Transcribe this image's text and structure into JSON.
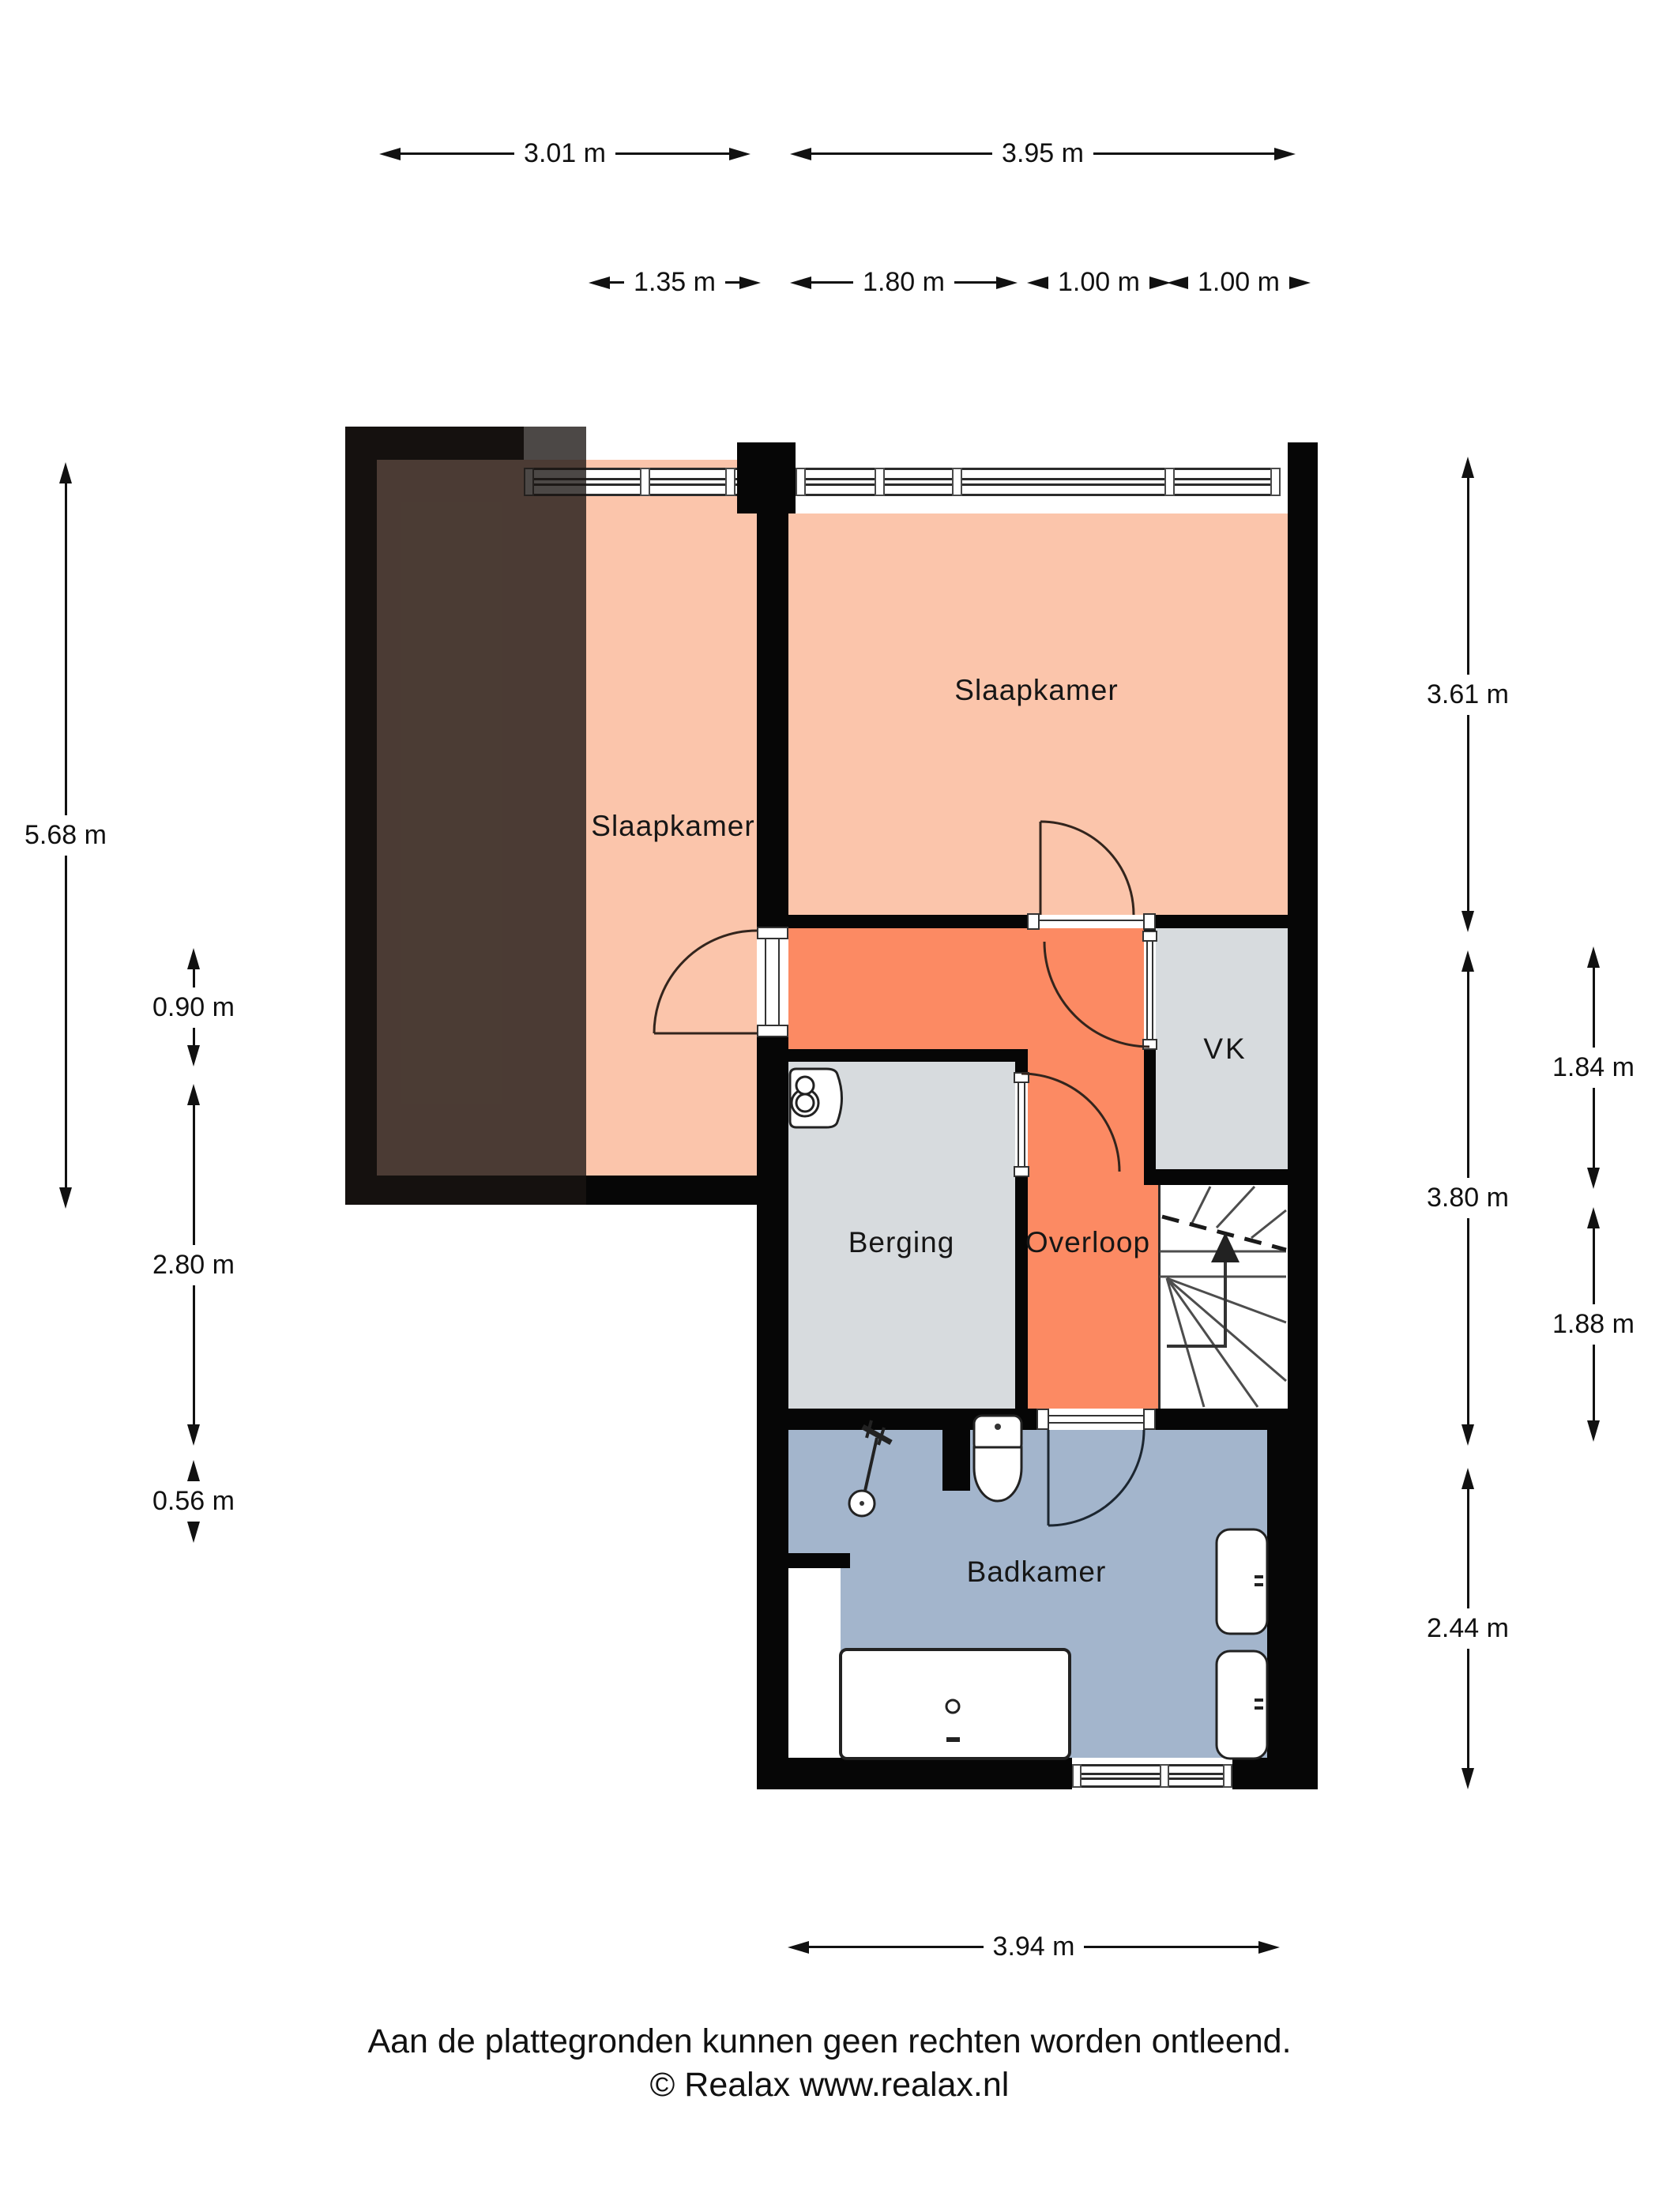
{
  "rooms": {
    "bed1": "Slaapkamer",
    "bed2": "Slaapkamer",
    "vk": "VK",
    "berging": "Berging",
    "overloop": "Overloop",
    "badkamer": "Badkamer"
  },
  "dims": {
    "w_bed1": "3.01 m",
    "w_bed2": "3.95 m",
    "w_door_zone": "1.35 m",
    "w_berging": "1.80 m",
    "w_overloop": "1.00 m",
    "w_vk": "1.00 m",
    "h_bed1": "5.68 m",
    "h_door": "0.90 m",
    "h_berging": "2.80 m",
    "h_niche": "0.56 m",
    "h_bed2": "3.61 m",
    "h_mid": "3.80 m",
    "h_vk": "1.84 m",
    "h_stairs": "1.88 m",
    "h_badkamer": "2.44 m",
    "w_badkamer": "3.94 m"
  },
  "footer": {
    "line1": "Aan de plattegronden kunnen geen rechten worden ontleend.",
    "line2": "© Realax www.realax.nl"
  },
  "colors": {
    "wall": "#060606",
    "bedroom": "#fbc5ab",
    "hallway": "#fc8a63",
    "storage": "#d7dbde",
    "bathroom": "#a3b5cc",
    "stairs_bg": "#ffffff"
  },
  "icons": {
    "boiler": "boiler-tank-top-view",
    "toilet": "toilet-top-view",
    "shower": "hand-shower-top-view",
    "washbasin": "washbasin-top-view",
    "bathtub": "bathtub-top-view",
    "stairs": "winder-stairs-up-arrow"
  }
}
